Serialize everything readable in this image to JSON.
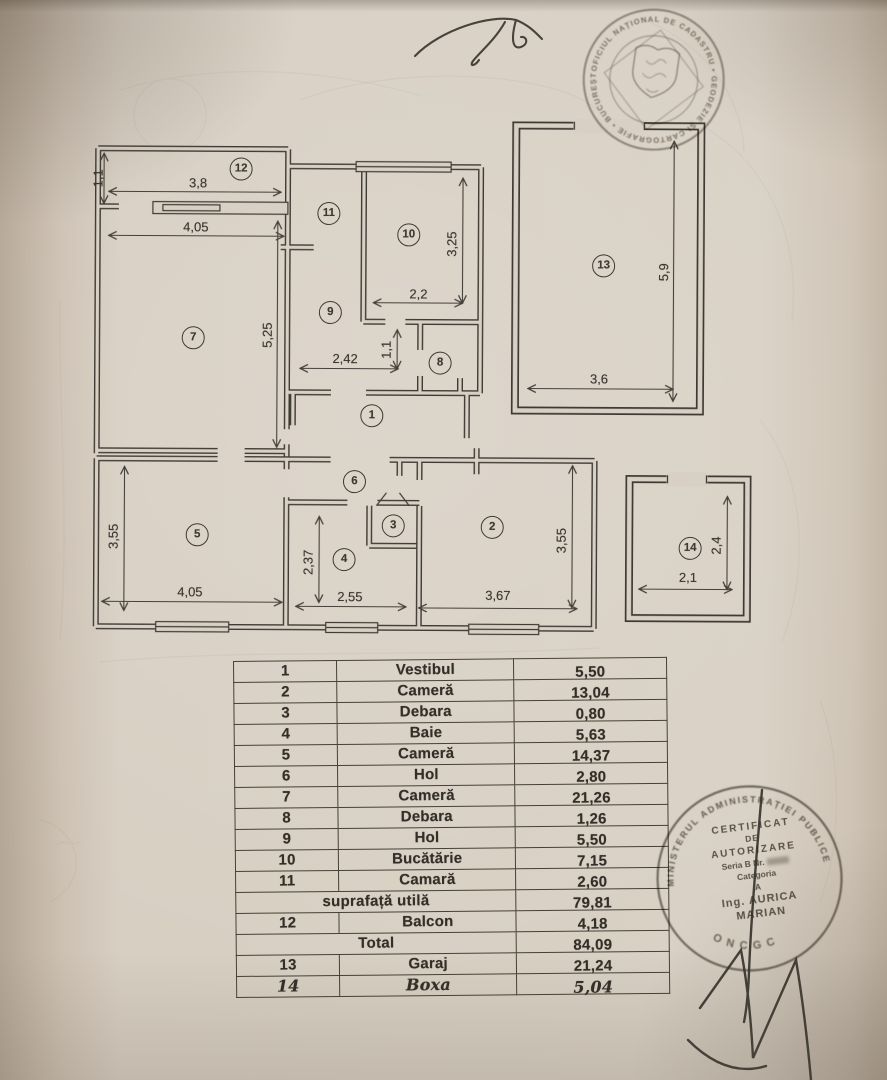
{
  "table": {
    "rows": [
      {
        "num": "1",
        "name": "Vestibul",
        "value": "5,50"
      },
      {
        "num": "2",
        "name": "Cameră",
        "value": "13,04"
      },
      {
        "num": "3",
        "name": "Debara",
        "value": "0,80"
      },
      {
        "num": "4",
        "name": "Baie",
        "value": "5,63"
      },
      {
        "num": "5",
        "name": "Cameră",
        "value": "14,37"
      },
      {
        "num": "6",
        "name": "Hol",
        "value": "2,80"
      },
      {
        "num": "7",
        "name": "Cameră",
        "value": "21,26"
      },
      {
        "num": "8",
        "name": "Debara",
        "value": "1,26"
      },
      {
        "num": "9",
        "name": "Hol",
        "value": "5,50"
      },
      {
        "num": "10",
        "name": "Bucătărie",
        "value": "7,15"
      },
      {
        "num": "11",
        "name": "Camară",
        "value": "2,60"
      },
      {
        "num": null,
        "name": "suprafață utilă",
        "value": "79,81",
        "bold": true
      },
      {
        "num": "12",
        "name": "Balcon",
        "value": "4,18"
      },
      {
        "num": null,
        "name": "Total",
        "value": "84,09",
        "bold": true
      },
      {
        "num": "13",
        "name": "Garaj",
        "value": "21,24"
      },
      {
        "num": "14",
        "name": "Boxa",
        "value": "5,04",
        "hand": true
      }
    ]
  },
  "floorplan": {
    "rooms": [
      {
        "n": "1",
        "x": 287,
        "y": 308
      },
      {
        "n": "2",
        "x": 408,
        "y": 419
      },
      {
        "n": "3",
        "x": 309,
        "y": 418
      },
      {
        "n": "4",
        "x": 260,
        "y": 452
      },
      {
        "n": "5",
        "x": 113,
        "y": 428
      },
      {
        "n": "6",
        "x": 270,
        "y": 374
      },
      {
        "n": "7",
        "x": 108,
        "y": 231
      },
      {
        "n": "8",
        "x": 355,
        "y": 255
      },
      {
        "n": "9",
        "x": 245,
        "y": 205
      },
      {
        "n": "10",
        "x": 323,
        "y": 127
      },
      {
        "n": "11",
        "x": 243,
        "y": 106
      },
      {
        "n": "12",
        "x": 155,
        "y": 62
      },
      {
        "n": "13",
        "x": 518,
        "y": 157
      },
      {
        "n": "14",
        "x": 606,
        "y": 439
      }
    ],
    "dims": [
      {
        "t": "1,1",
        "x": 12,
        "y": 72,
        "r": -90
      },
      {
        "t": "3,8",
        "x": 112,
        "y": 76,
        "r": 0
      },
      {
        "t": "4,05",
        "x": 110,
        "y": 120,
        "r": 0
      },
      {
        "t": "5,25",
        "x": 182,
        "y": 228,
        "r": -90
      },
      {
        "t": "3,25",
        "x": 366,
        "y": 136,
        "r": -90
      },
      {
        "t": "2,2",
        "x": 333,
        "y": 186,
        "r": 0
      },
      {
        "t": "2,42",
        "x": 260,
        "y": 251,
        "r": 0
      },
      {
        "t": "1,1",
        "x": 301,
        "y": 242,
        "r": -90
      },
      {
        "t": "5,9",
        "x": 578,
        "y": 163,
        "r": -90
      },
      {
        "t": "3,6",
        "x": 514,
        "y": 270,
        "r": 0
      },
      {
        "t": "3,55",
        "x": 29,
        "y": 430,
        "r": -90
      },
      {
        "t": "4,05",
        "x": 106,
        "y": 485,
        "r": 0
      },
      {
        "t": "2,37",
        "x": 224,
        "y": 455,
        "r": -90
      },
      {
        "t": "2,55",
        "x": 266,
        "y": 489,
        "r": 0
      },
      {
        "t": "3,67",
        "x": 414,
        "y": 487,
        "r": 0
      },
      {
        "t": "3,55",
        "x": 477,
        "y": 432,
        "r": -90
      },
      {
        "t": "2,1",
        "x": 604,
        "y": 468,
        "r": 0
      },
      {
        "t": "2,4",
        "x": 632,
        "y": 436,
        "r": -90
      }
    ]
  },
  "stamps": {
    "top": {
      "ring_text": "OFICIUL NAȚIONAL DE CADASTRU • GEODEZIE ȘI CARTOGRAFIE • BUCUREȘTI •"
    },
    "bottom": {
      "ring_top": "MINISTERUL ADMINISTRAȚIEI PUBLICE",
      "ring_bottom": "ONCGC",
      "lines": [
        "CERTIFICAT",
        "DE",
        "AUTORIZARE",
        "Seria B Nr.",
        "Categoria",
        "A",
        "Ing. AURICA",
        "MARIAN"
      ]
    }
  }
}
